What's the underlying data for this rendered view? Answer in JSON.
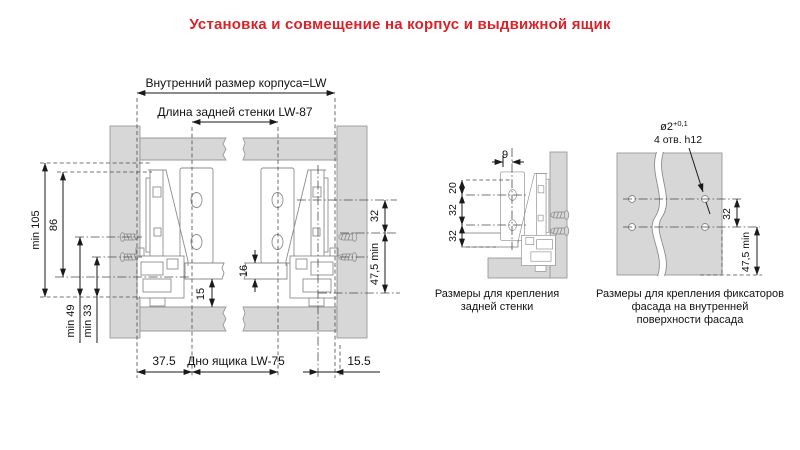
{
  "title": "Установка и совмещение на корпус и выдвижной ящик",
  "colors": {
    "accent": "#d8232a",
    "panel_gray": "#d7d7d7",
    "outline_gray": "#8d8d8d",
    "dim_line": "#1a1a1a"
  },
  "main_view": {
    "dim_inner_width": "Внутренний размер корпуса=LW",
    "dim_back_wall": "Длина задней стенки  LW-87",
    "dim_min105": "min 105",
    "dim_86": "86",
    "dim_min49": "min 49",
    "dim_min33": "min 33",
    "dim_32": "32",
    "dim_475": "47,5 min",
    "dim_16": "16",
    "dim_15": "15",
    "dim_375": "37.5",
    "dim_bottom": "Дно ящика  LW-75",
    "dim_155": "15.5"
  },
  "back_wall_view": {
    "dim_9": "9",
    "dim_20": "20",
    "dim_32a": "32",
    "dim_32b": "32",
    "caption_line1": "Размеры для крепления",
    "caption_line2": "задней стенки"
  },
  "facade_view": {
    "hole_dia": "ø2",
    "hole_tol": "+0,1",
    "holes_note": "4 отв. h12",
    "dim_32": "32",
    "dim_475": "47,5 min",
    "caption_line1": "Размеры для крепления фиксаторов",
    "caption_line2": "фасада на внутренней",
    "caption_line3": "поверхности фасада"
  }
}
